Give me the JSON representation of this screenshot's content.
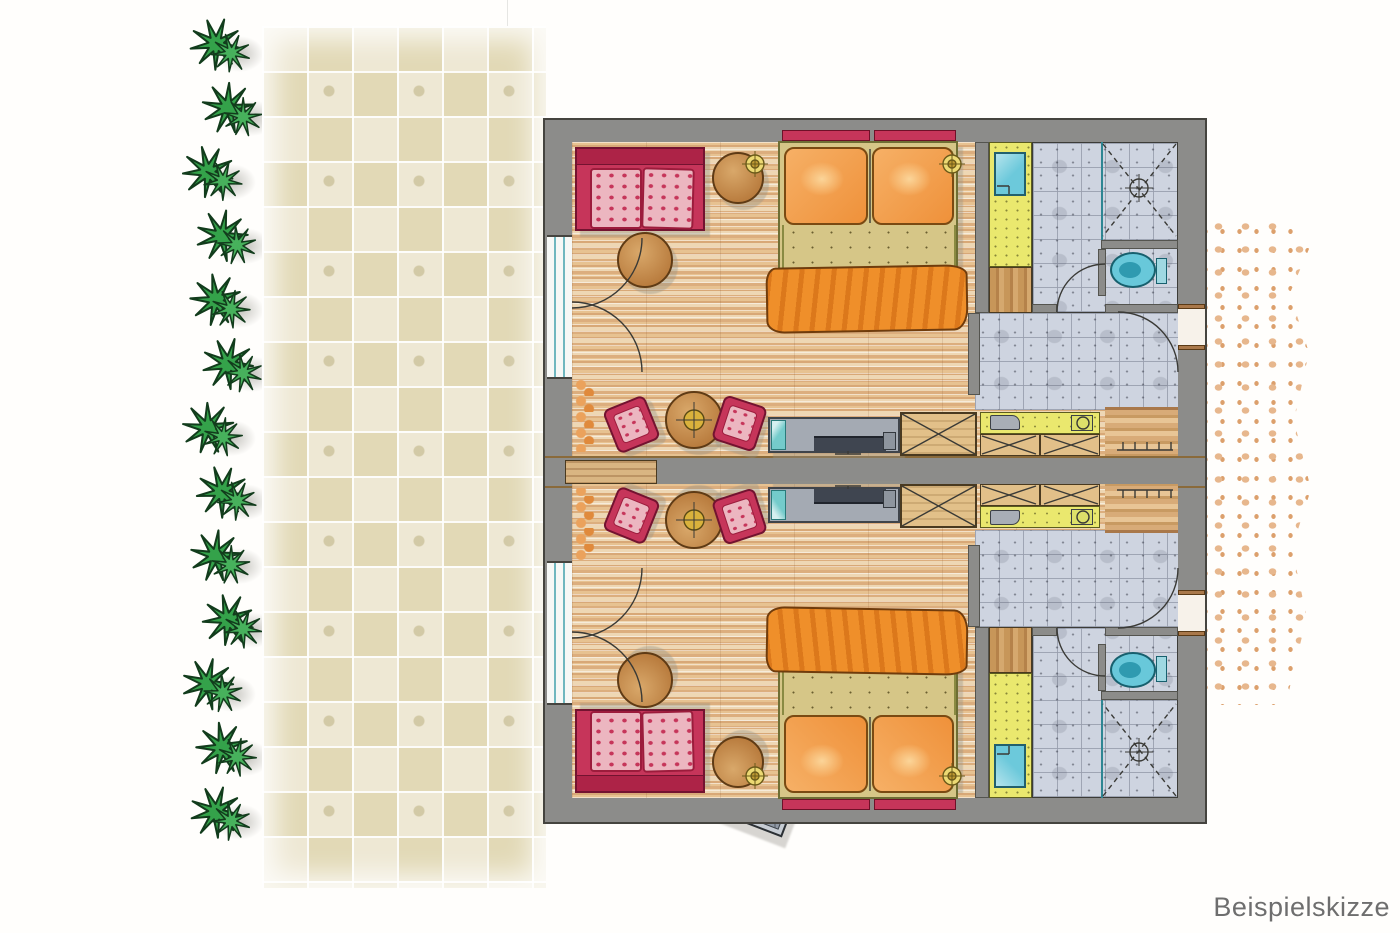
{
  "caption": {
    "label": "Beispielskizze"
  },
  "scene": {
    "description": "Hand-drawn colored floor plan sketch: two mirrored hotel guest rooms with bathrooms and entry halls, a stone-paved terrace with sun loungers and patio set, a hedge on the left and a gravel path on the right",
    "rooms": {
      "count": 2,
      "labels": [
        "guest-room-upper",
        "guest-room-lower"
      ]
    },
    "terrace": {
      "hedge_plant_count": 13,
      "sun_lounger_count": 4,
      "patio_chair_count": 4,
      "patio_table_count": 1
    },
    "furniture_per_room": [
      "sofa",
      "coffee-table",
      "side-table",
      "double-bed",
      "wall-lamps",
      "dining-table",
      "dining-chairs",
      "curtain",
      "sideboard-desk",
      "tv",
      "stool",
      "wardrobe",
      "minibar-counter",
      "cabinet-row",
      "washbasin-vanity",
      "storage-niche",
      "shower",
      "toilet",
      "coat-hooks"
    ]
  },
  "colors": {
    "wall_gray": "#8c8c8a",
    "wood_floor": "#ecd0a8",
    "bath_tile": "#ced4e0",
    "terrace_paver": "#e9e2c8",
    "sofa_red": "#c6355a",
    "cushion_pink": "#ecb6c0",
    "bed_orange": "#ef8f2a",
    "linen_yellow": "#f0e46a",
    "fixture_cyan": "#66c6da",
    "vanity_yellow": "#eae86e",
    "table_wood": "#c08448",
    "hedge_green": "#34a24a",
    "gravel_dots": "#e5b48c",
    "caption_text": "#6e6e6e"
  }
}
